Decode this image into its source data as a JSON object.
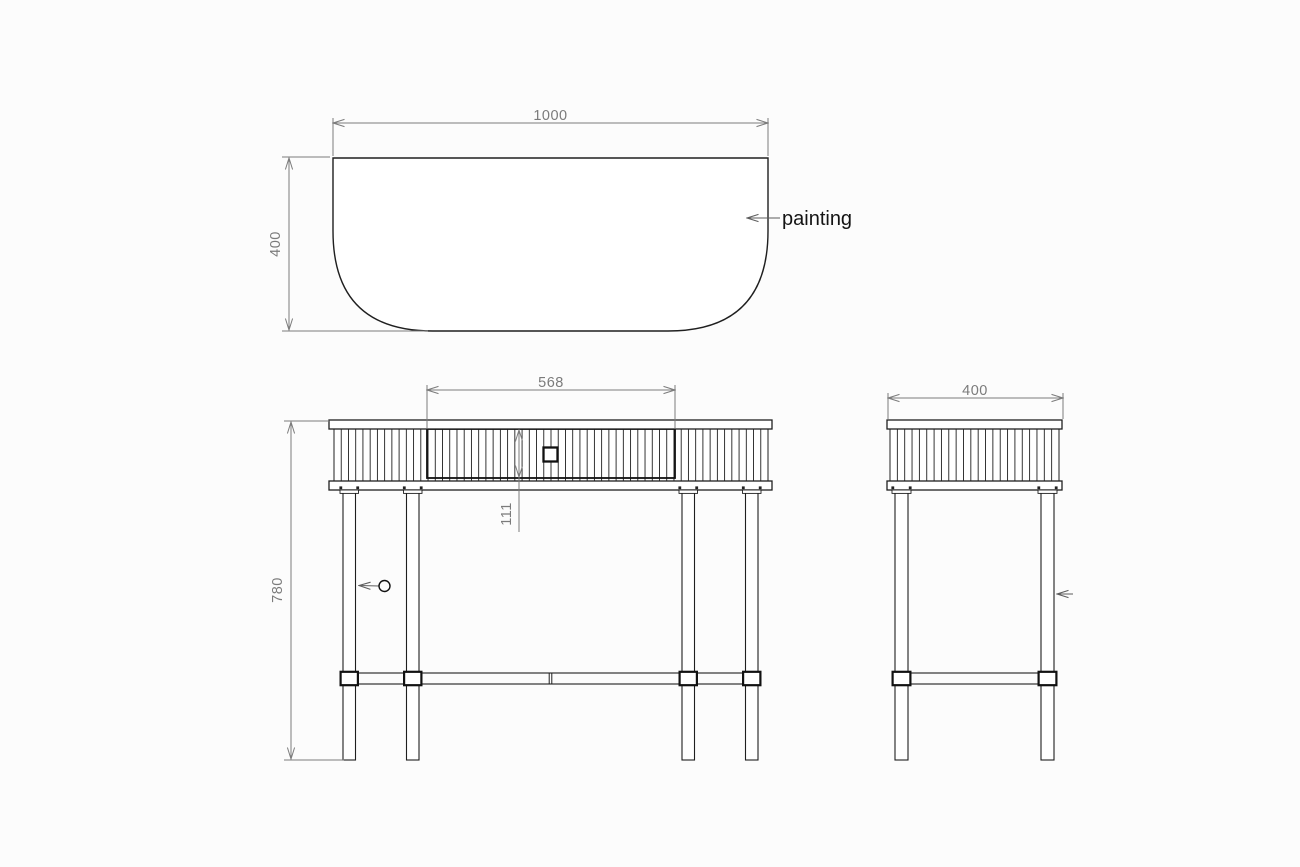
{
  "drawing": {
    "callouts": {
      "painting_label": "painting"
    },
    "top_view": {
      "width_mm": "1000",
      "depth_mm": "400"
    },
    "front_view": {
      "drawer_width_mm": "568",
      "drawer_height_mm": "111",
      "total_height_mm": "780"
    },
    "side_view": {
      "depth_mm": "400"
    },
    "colors": {
      "object_line": "#1f1f1f",
      "dimension_line": "#7b7b7b",
      "leader_line": "#5d5d5d",
      "background": "#fcfcfc"
    }
  }
}
